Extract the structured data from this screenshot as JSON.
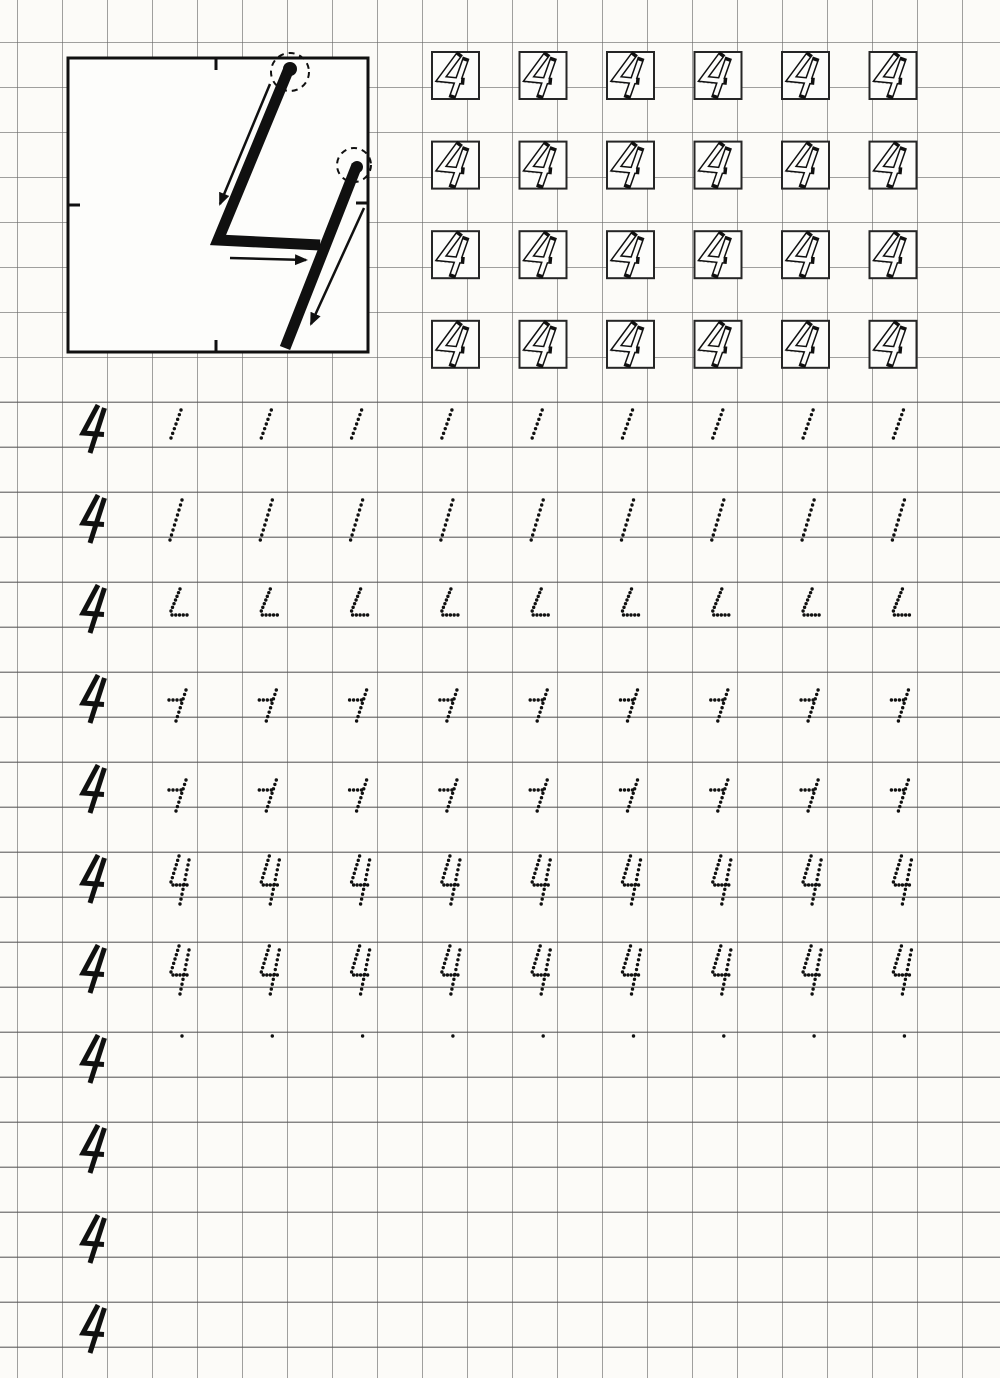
{
  "document": {
    "kind": "handwriting-practice-worksheet",
    "digit": "4",
    "description": "Scanned squared-paper worksheet for learning to write the numeral 4: an instruction box with stroke-order arrows and start-point circles, four rows of outlined 4s in bold trace squares, then eleven ruled practice rows with a solid model 4 at the left and dotted tracing glyphs that build the numeral stroke by stroke (short diagonal, full diagonal, diagonal with foot, bar with tail stroke, complete dotted 4, start dots, and empty rows)."
  },
  "palette": {
    "paper": "#fcfbf8",
    "box_fill": "#fdfdfb",
    "white": "#fdfdfb",
    "grid_line": "rgba(104,104,104,0.62)",
    "guide_line": "rgba(70,70,70,0.40)",
    "ink": "#101010",
    "square_border": "#262626",
    "ghost": "#b3b3b3"
  },
  "grid": {
    "cell": 45,
    "offset_x": 17,
    "offset_y": -3
  },
  "instruction_box": {
    "x": 68,
    "y": 58,
    "width": 300,
    "height": 294,
    "border_width": 3,
    "strokes": [
      {
        "name": "first-stroke",
        "points": [
          [
            290,
            66
          ],
          [
            218,
            240
          ],
          [
            320,
            245
          ]
        ],
        "width": 11
      },
      {
        "name": "second-stroke",
        "points": [
          [
            357,
            165
          ],
          [
            285,
            348
          ]
        ],
        "width": 11
      }
    ],
    "start_markers": [
      {
        "dot": [
          290,
          69
        ],
        "dot_r": 7,
        "circle": [
          290,
          72
        ],
        "circle_r": 19
      },
      {
        "dot": [
          357,
          167
        ],
        "dot_r": 6,
        "circle": [
          354,
          165
        ],
        "circle_r": 17
      }
    ],
    "arrows": [
      {
        "from": [
          270,
          84
        ],
        "to": [
          220,
          204
        ]
      },
      {
        "from": [
          230,
          258
        ],
        "to": [
          306,
          260
        ]
      },
      {
        "from": [
          364,
          208
        ],
        "to": [
          311,
          324
        ]
      }
    ],
    "ticks": [
      [
        [
          216,
          58
        ],
        [
          216,
          70
        ]
      ],
      [
        [
          68,
          205
        ],
        [
          80,
          205
        ]
      ],
      [
        [
          216,
          340
        ],
        [
          216,
          352
        ]
      ],
      [
        [
          356,
          203
        ],
        [
          368,
          203
        ]
      ]
    ]
  },
  "trace_squares": {
    "rows": 4,
    "cols": 6,
    "x0": 432,
    "y0": 52,
    "pitch_x": 87.5,
    "pitch_y": 89.6,
    "size": 47,
    "border_width": 2,
    "glyph": {
      "paths": [
        "M26 4 L9 27 L29 29",
        "M33 9 L21 43"
      ],
      "outer_width": 7,
      "inner_width": 4,
      "ghost_offset": [
        -4,
        3
      ]
    }
  },
  "practice_rows": {
    "model_x": 78,
    "glyph_x0": 168,
    "glyph_pitch": 90.3,
    "y0": 402,
    "pitch_y": 90,
    "baseline_offset": 45,
    "glyphs_per_row": 9,
    "model": {
      "paths": [
        "M20 2 L5 30 L26 31.5",
        "M26.5 5 L12 50"
      ],
      "stroke_width": 5
    },
    "rows": [
      {
        "row": 1,
        "glyph": "diag_short"
      },
      {
        "row": 2,
        "glyph": "diag_full"
      },
      {
        "row": 3,
        "glyph": "diag_elbow"
      },
      {
        "row": 4,
        "glyph": "horiz_diag"
      },
      {
        "row": 5,
        "glyph": "horiz_diag"
      },
      {
        "row": 6,
        "glyph": "full4"
      },
      {
        "row": 7,
        "glyph": "full4"
      },
      {
        "row": 8,
        "glyph": "start_dot"
      },
      {
        "row": 9,
        "glyph": "none"
      },
      {
        "row": 10,
        "glyph": "none"
      },
      {
        "row": 11,
        "glyph": "none"
      }
    ]
  },
  "trace_glyphs": {
    "dot_radius": 1.7,
    "defs": {
      "diag_short": {
        "dy": 6,
        "strokes": [
          [
            13,
            2,
            3,
            30,
            7
          ]
        ]
      },
      "diag_full": {
        "dy": 6,
        "strokes": [
          [
            14,
            2,
            2,
            42,
            9
          ]
        ]
      },
      "diag_elbow": {
        "dy": 5,
        "strokes": [
          [
            12,
            2,
            3,
            24,
            7
          ],
          [
            4,
            28,
            19,
            28,
            5
          ]
        ]
      },
      "horiz_diag": {
        "dy": 16,
        "strokes": [
          [
            1,
            12,
            13,
            12,
            4
          ],
          [
            18,
            2,
            8,
            33,
            8
          ]
        ]
      },
      "full4": {
        "dy": 2,
        "strokes": [
          [
            11,
            2,
            3,
            28,
            7
          ],
          [
            5,
            31,
            19,
            31,
            5
          ],
          [
            21,
            6,
            12,
            50,
            10
          ]
        ]
      },
      "start_dot": {
        "dy": 1,
        "strokes": [
          [
            14,
            3,
            14,
            3,
            1
          ]
        ]
      },
      "none": {
        "dy": 0,
        "strokes": []
      }
    }
  }
}
